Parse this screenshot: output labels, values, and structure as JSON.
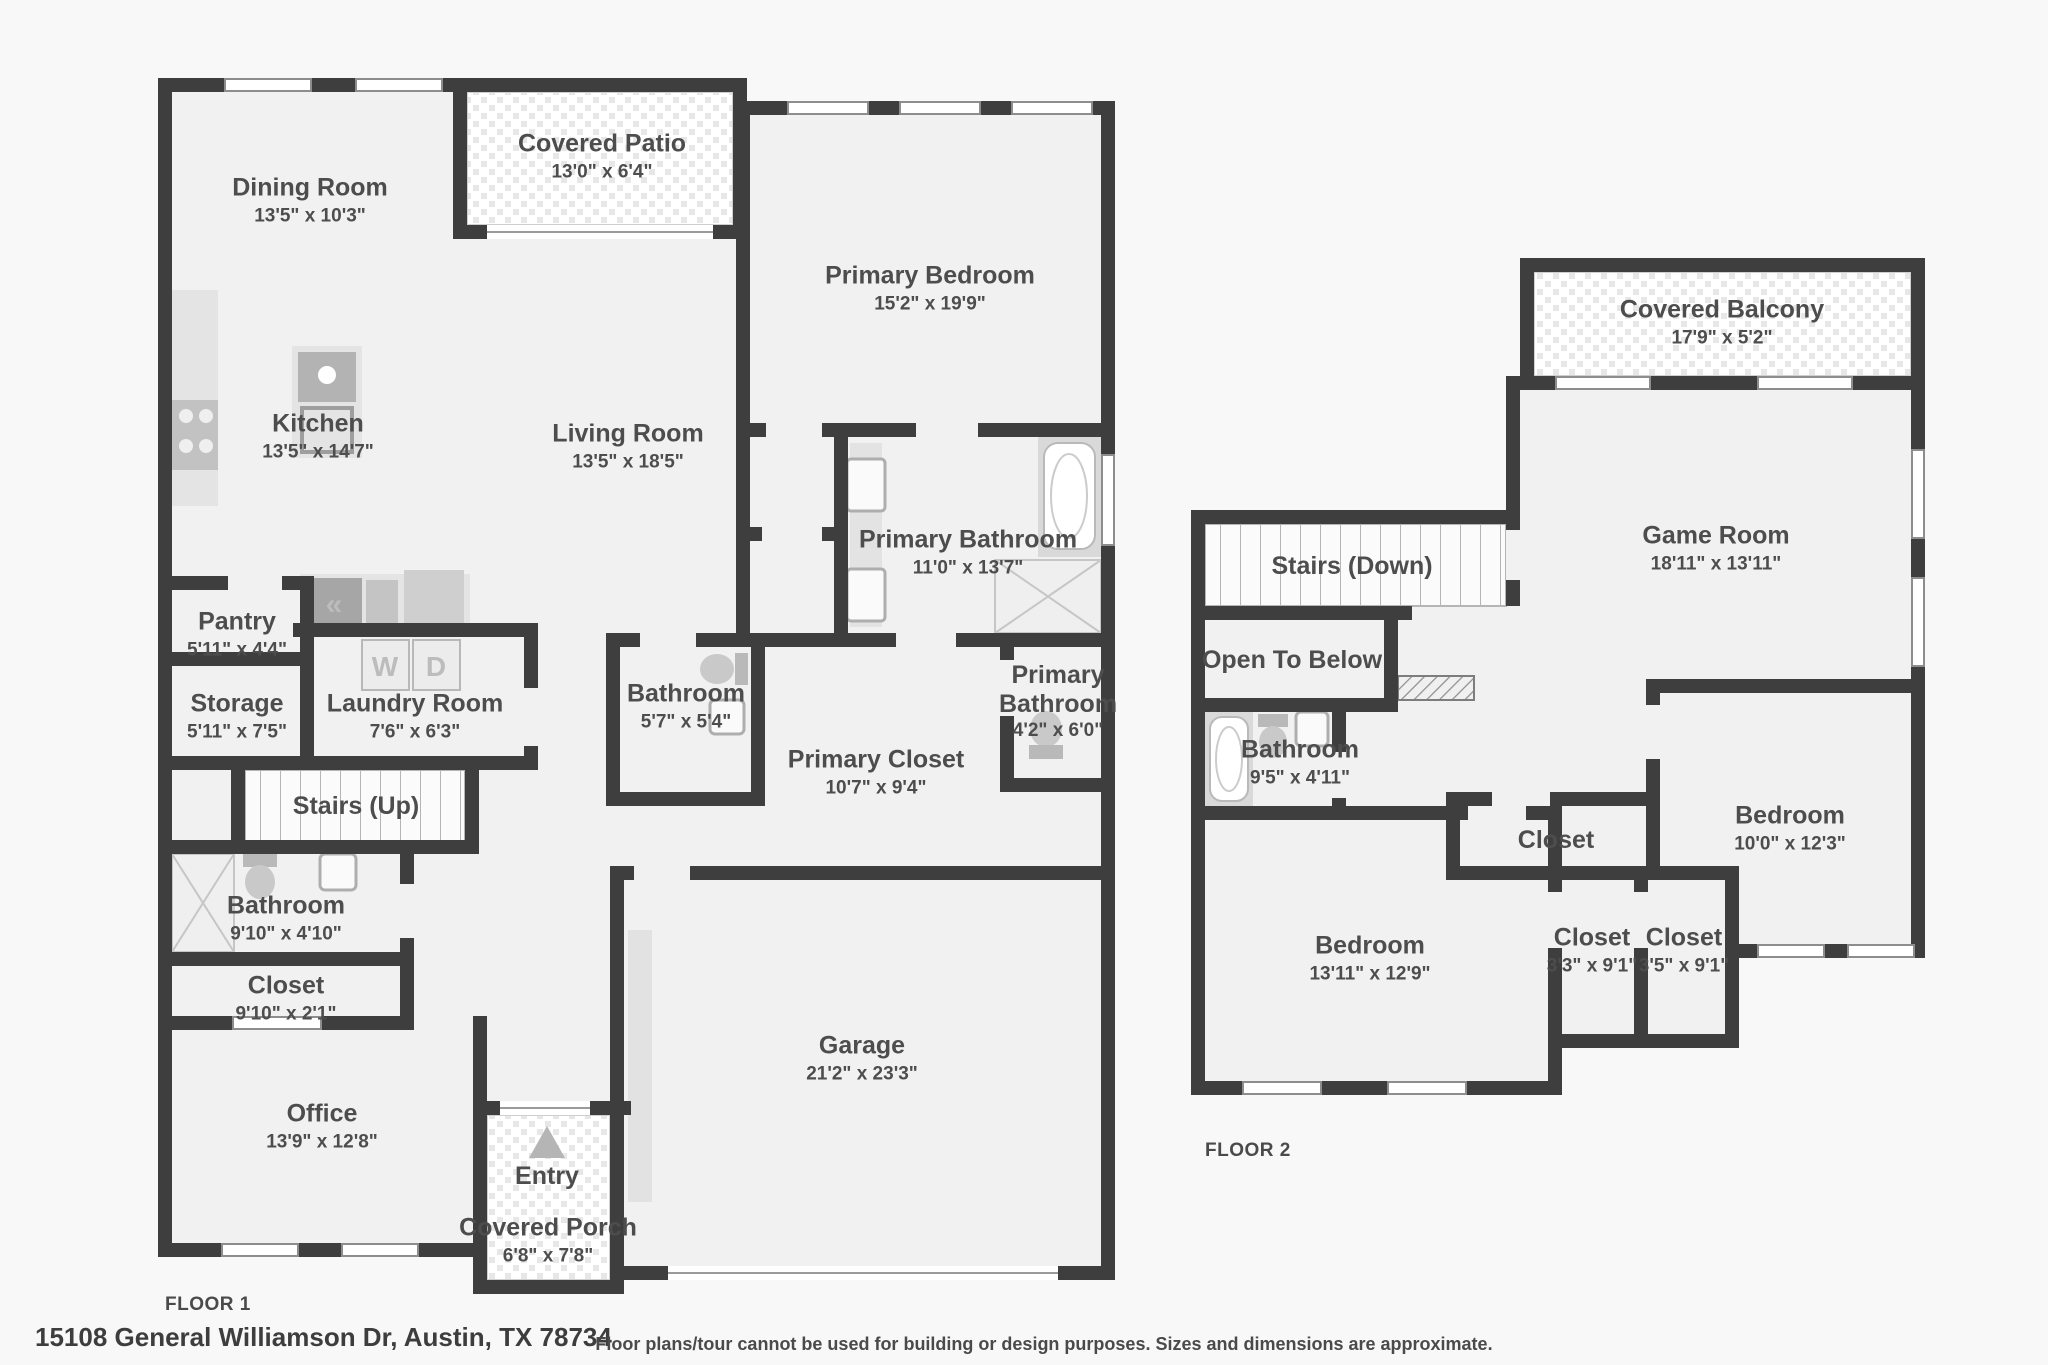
{
  "palette": {
    "wall": "#3e3e3e",
    "room_fill": "#f1f1f1",
    "fixture_gray": "#c9c9c9",
    "counter_gray": "#e4e4e4",
    "label": "#4d4d4d"
  },
  "floor1": {
    "title": "FLOOR 1",
    "rooms": [
      {
        "name": "Dining Room",
        "dims": "13'5\" x 10'3\""
      },
      {
        "name": "Covered Patio",
        "dims": "13'0\" x 6'4\""
      },
      {
        "name": "Primary Bedroom",
        "dims": "15'2\" x 19'9\""
      },
      {
        "name": "Kitchen",
        "dims": "13'5\" x 14'7\""
      },
      {
        "name": "Living Room",
        "dims": "13'5\" x 18'5\""
      },
      {
        "name": "Primary Bathroom",
        "dims": "11'0\" x 13'7\""
      },
      {
        "name": "Pantry",
        "dims": "5'11\" x 4'4\""
      },
      {
        "name": "Laundry Room",
        "dims": "7'6\" x 6'3\""
      },
      {
        "name": "Bathroom",
        "dims": "5'7\" x 5'4\""
      },
      {
        "name": "Primary Bathroom",
        "dims": "4'2\" x 6'0\""
      },
      {
        "name": "Storage",
        "dims": "5'11\" x 7'5\""
      },
      {
        "name": "Primary Closet",
        "dims": "10'7\" x 9'4\""
      },
      {
        "name": "Stairs (Up)",
        "dims": ""
      },
      {
        "name": "Bathroom",
        "dims": "9'10\" x 4'10\""
      },
      {
        "name": "Closet",
        "dims": "9'10\" x 2'1\""
      },
      {
        "name": "Office",
        "dims": "13'9\" x 12'8\""
      },
      {
        "name": "Entry",
        "dims": ""
      },
      {
        "name": "Covered Porch",
        "dims": "6'8\" x 7'8\""
      },
      {
        "name": "Garage",
        "dims": "21'2\" x 23'3\""
      }
    ]
  },
  "floor2": {
    "title": "FLOOR 2",
    "rooms": [
      {
        "name": "Covered Balcony",
        "dims": "17'9\" x 5'2\""
      },
      {
        "name": "Game Room",
        "dims": "18'11\" x 13'11\""
      },
      {
        "name": "Stairs (Down)",
        "dims": ""
      },
      {
        "name": "Open To Below",
        "dims": ""
      },
      {
        "name": "Bathroom",
        "dims": "9'5\" x 4'11\""
      },
      {
        "name": "Closet",
        "dims": ""
      },
      {
        "name": "Bedroom",
        "dims": "10'0\" x 12'3\""
      },
      {
        "name": "Bedroom",
        "dims": "13'11\" x 12'9\""
      },
      {
        "name": "Closet",
        "dims": "3'3\" x 9'1\""
      },
      {
        "name": "Closet",
        "dims": "3'5\" x 9'1\""
      }
    ]
  },
  "fixtures": {
    "washer": "W",
    "dryer": "D",
    "oven": "«"
  },
  "footer": {
    "address": "15108 General Williamson Dr, Austin, TX 78734",
    "disclaimer": "Floor plans/tour cannot be used for building or design purposes. Sizes and dimensions are approximate."
  }
}
